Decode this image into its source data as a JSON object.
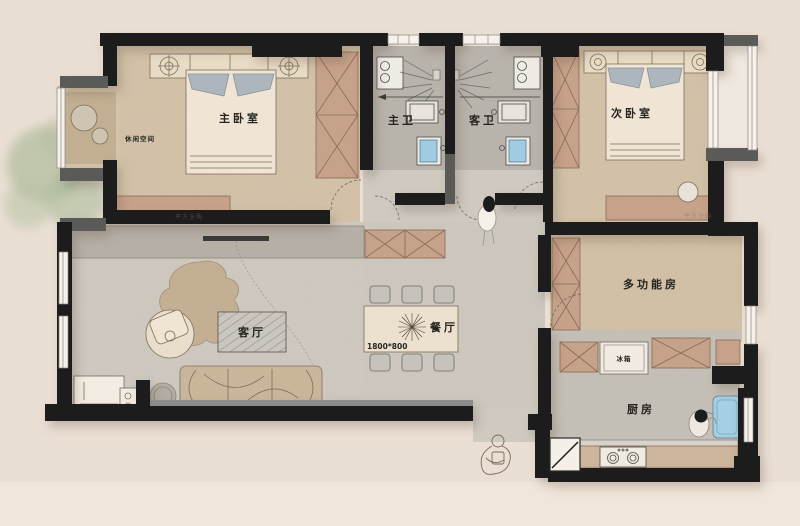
{
  "floorplan": {
    "rooms": {
      "master_bedroom": "主卧室",
      "master_bathroom": "主卫",
      "guest_bathroom": "客卫",
      "second_bedroom": "次卧室",
      "multifunction_room": "多功能房",
      "living_room": "客厅",
      "dining_room": "餐厅",
      "kitchen": "厨房",
      "leisure_area": "休闲空间"
    },
    "annotations": {
      "fridge": "冰箱",
      "dining_table_size": "1800*800",
      "watermark": "平方全购"
    },
    "colors": {
      "background": "#eadfd4",
      "wall": "#1e1d1b",
      "wall_secondary": "#5a5a58",
      "bedroom_floor": "#d7c6ac",
      "bathroom_floor": "#b9b4ac",
      "living_floor": "#d0cac1",
      "wood_furniture": "#c7a28a",
      "cream_furniture": "#efe4d2",
      "fixture_blue": "#9fcbe3",
      "pillow_gray": "#aeb6bd",
      "tree_green": "#b3bfa0"
    }
  }
}
